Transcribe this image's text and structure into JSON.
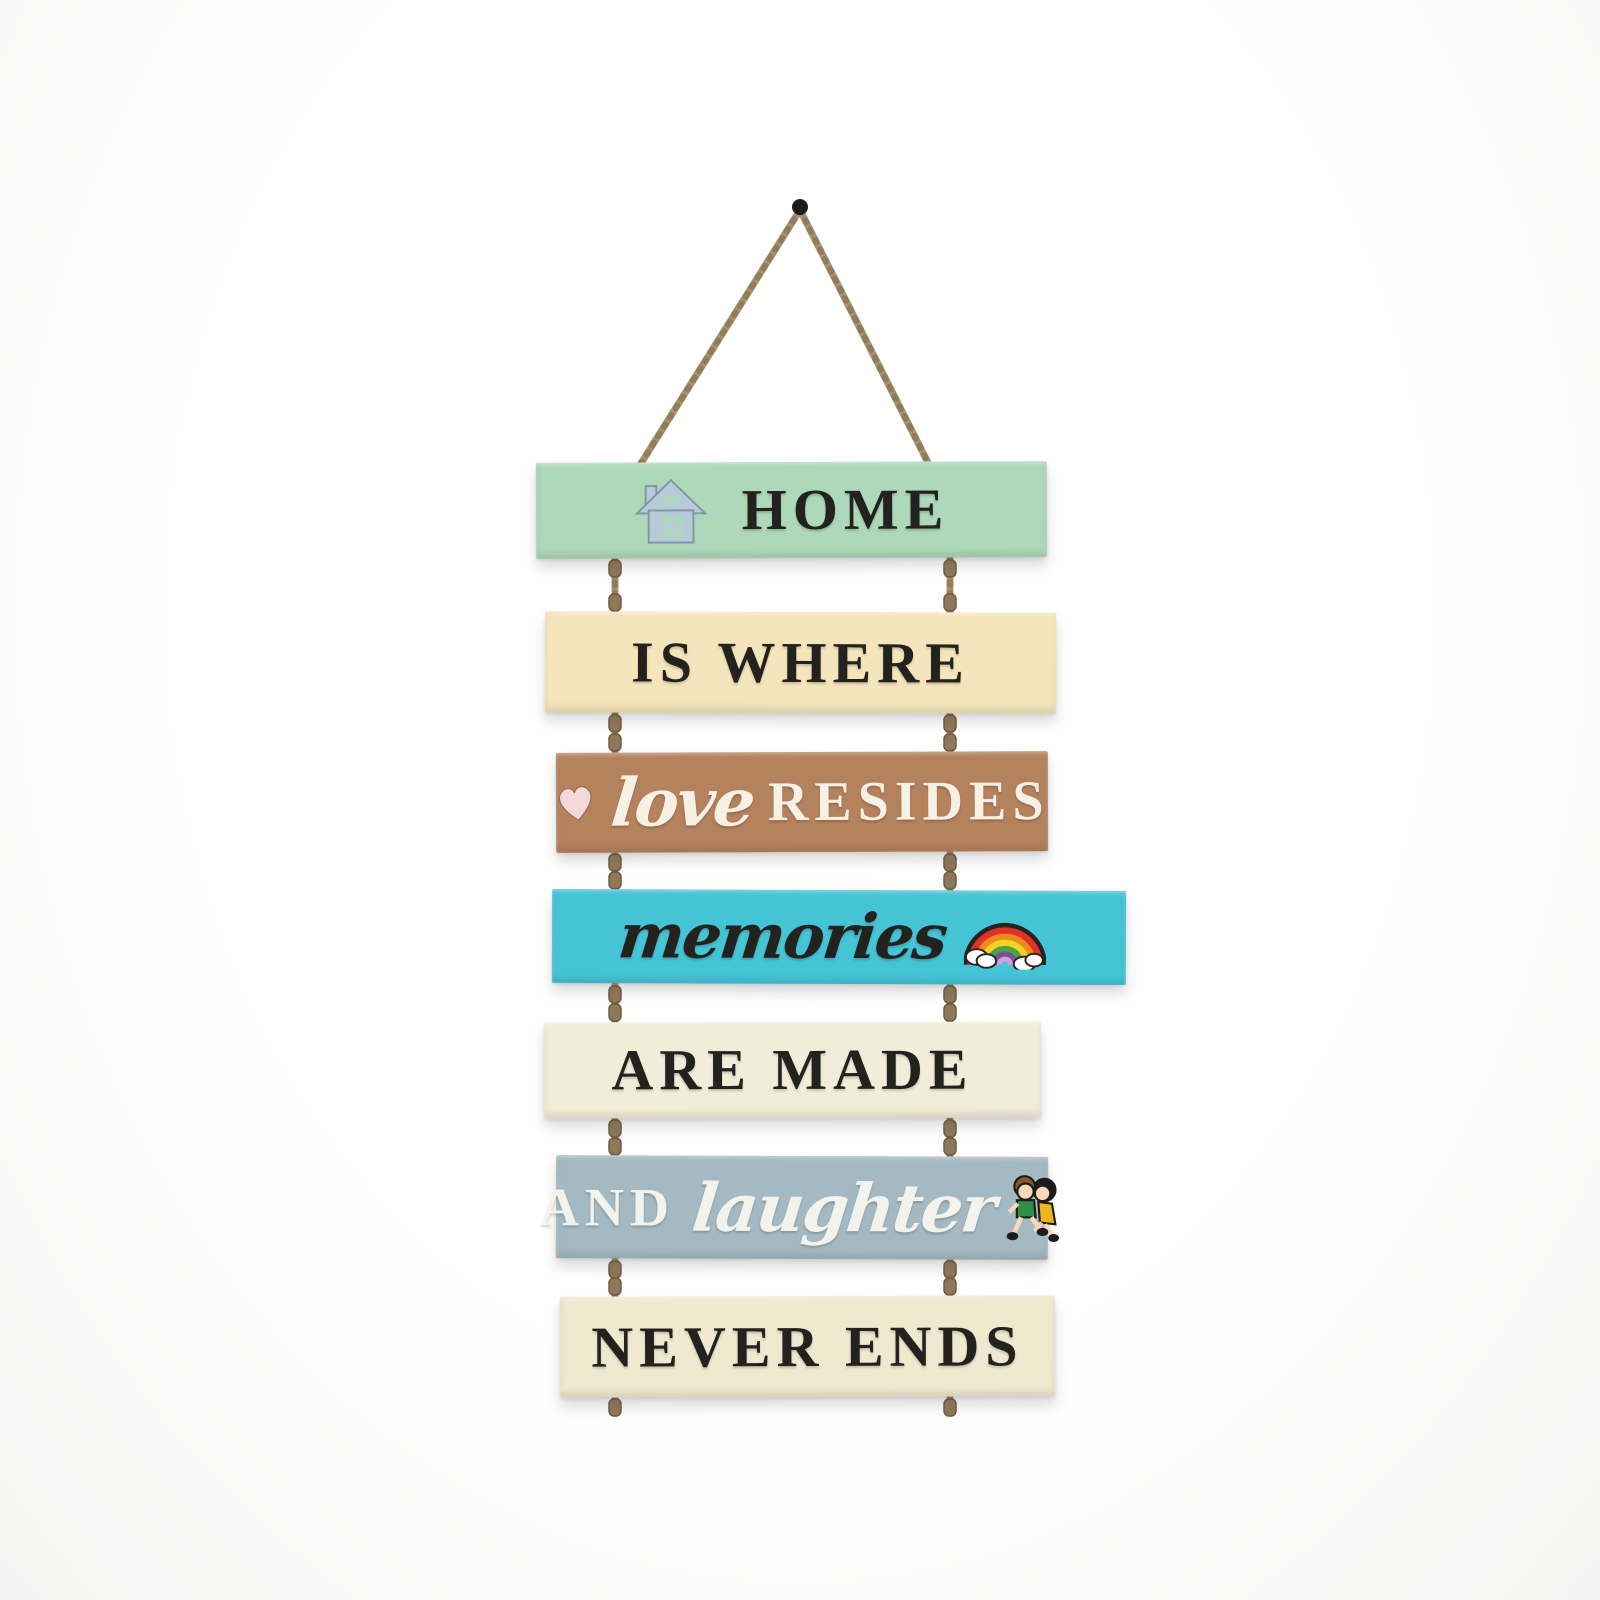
{
  "scene": {
    "description": "Hanging wall decor: seven painted wooden planks strung on jute rope from a nail",
    "background_color": "#ffffff",
    "rope_color": "#a9926e",
    "rope_shade_color": "#7f6a4e",
    "nail_color": "#1e1d1a",
    "full_phrase": "HOME IS WHERE love RESIDES memories ARE MADE AND laughter NEVER ENDS"
  },
  "planks": [
    {
      "label": "HOME",
      "color": "#aed8ba",
      "text_color": "#23221e",
      "icon": "house-icon"
    },
    {
      "label": "IS WHERE",
      "color": "#f5e5bc",
      "text_color": "#23221e"
    },
    {
      "script": "love",
      "label": "RESIDES",
      "color": "#b5825e",
      "text_color": "#f6f1e4",
      "icon": "heart-icon"
    },
    {
      "script": "memories",
      "color": "#45c4d6",
      "text_color": "#23221e",
      "icon": "rainbow-icon"
    },
    {
      "label": "ARE MADE",
      "color": "#f2edd9",
      "text_color": "#23221e"
    },
    {
      "label": "AND",
      "script": "laughter",
      "color": "#a4b9c1",
      "text_color": "#f2f3ec",
      "icon": "children-running-icon"
    },
    {
      "label": "NEVER ENDS",
      "color": "#efe9d0",
      "text_color": "#23221e"
    }
  ],
  "icon_colors": {
    "house_body": "#b6cbd7",
    "house_outline": "#7f98a6",
    "heart": "#f4d9da",
    "rainbow_bands": [
      "#e03226",
      "#ef8b1e",
      "#f4d323",
      "#4aa343",
      "#7b4f9e",
      "#cfa3d8"
    ],
    "cloud": "#ffffff",
    "boy_shirt": "#2f8f46",
    "girl_dress": "#efb51f",
    "skin": "#f8d8b8",
    "boy_hair": "#8a5a2e",
    "girl_hair": "#1d1c1a"
  }
}
